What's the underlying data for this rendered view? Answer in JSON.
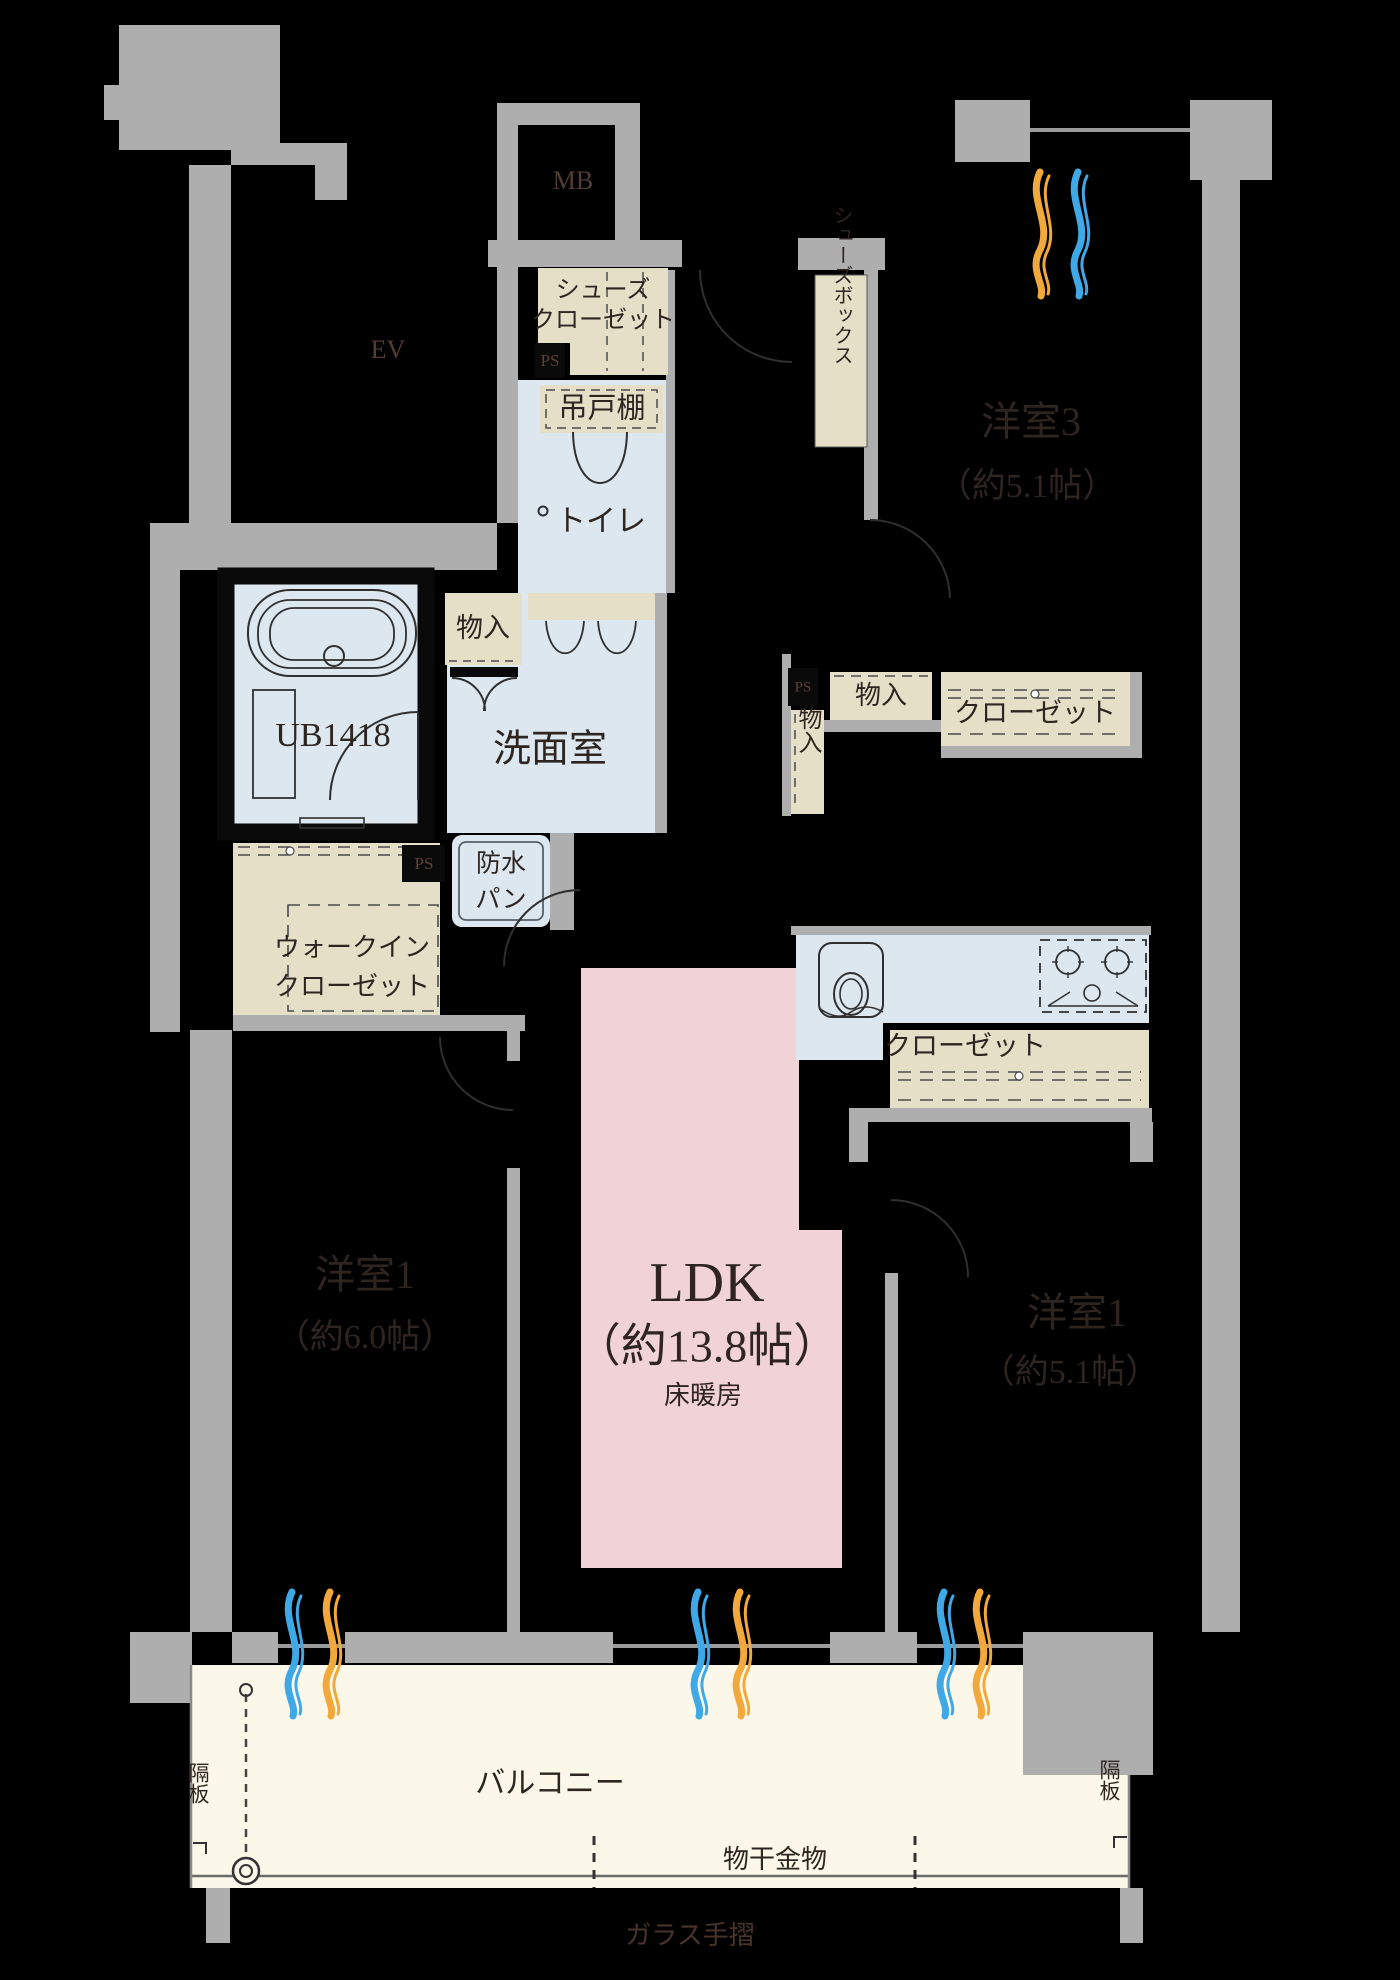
{
  "plan": {
    "type": "apartment-floor-plan",
    "units": "帖",
    "rooms": [
      {
        "name": "洋室3",
        "size_text": "（約5.1帖）"
      },
      {
        "name": "洋室1",
        "size_text": "（約6.0帖）"
      },
      {
        "name": "洋室1",
        "size_text": "（約5.1帖）"
      },
      {
        "name": "LDK",
        "size_text": "（約13.8帖）",
        "note": "床暖房"
      }
    ]
  },
  "labels": {
    "mb": "MB",
    "ev": "EV",
    "ps1": "PS",
    "ps2": "PS",
    "ps3": "PS",
    "shoes_closet_1": "シューズ",
    "shoes_closet_2": "クローゼット",
    "hanging_cupboard": "吊戸棚",
    "toilet": "トイレ",
    "shoes_box": "シューズボックス",
    "room3_name": "洋室3",
    "room3_size": "（約5.1帖）",
    "storage1": "物入",
    "storage2": "物入",
    "storage3": "物入",
    "ub": "UB1418",
    "washroom": "洗面室",
    "waterproof_1": "防水",
    "waterproof_2": "パン",
    "wic_1": "ウォークイン",
    "wic_2": "クローゼット",
    "closet1": "クローゼット",
    "closet2": "クローゼット",
    "ldk_name": "LDK",
    "ldk_size": "（約13.8帖）",
    "ldk_floor_heating": "床暖房",
    "room1l_name": "洋室1",
    "room1l_size": "（約6.0帖）",
    "room1r_name": "洋室1",
    "room1r_size": "（約5.1帖）",
    "balcony": "バルコニー",
    "drying_hardware": "物干金物",
    "glass_handrail": "ガラス手摺",
    "partition_left": "隔板",
    "partition_right": "隔板"
  },
  "colors": {
    "background": "#000000",
    "wall": "#AEAEAE",
    "wet_floor": "#DCE7EF",
    "closet": "#E6DFC8",
    "ldk": "#F1D2D6",
    "balcony": "#FBF7E9",
    "wave_blue": "#3FA9E8",
    "wave_orange": "#F2A93B",
    "label_dark": "#2E2420",
    "label_dim": "#533C33"
  }
}
